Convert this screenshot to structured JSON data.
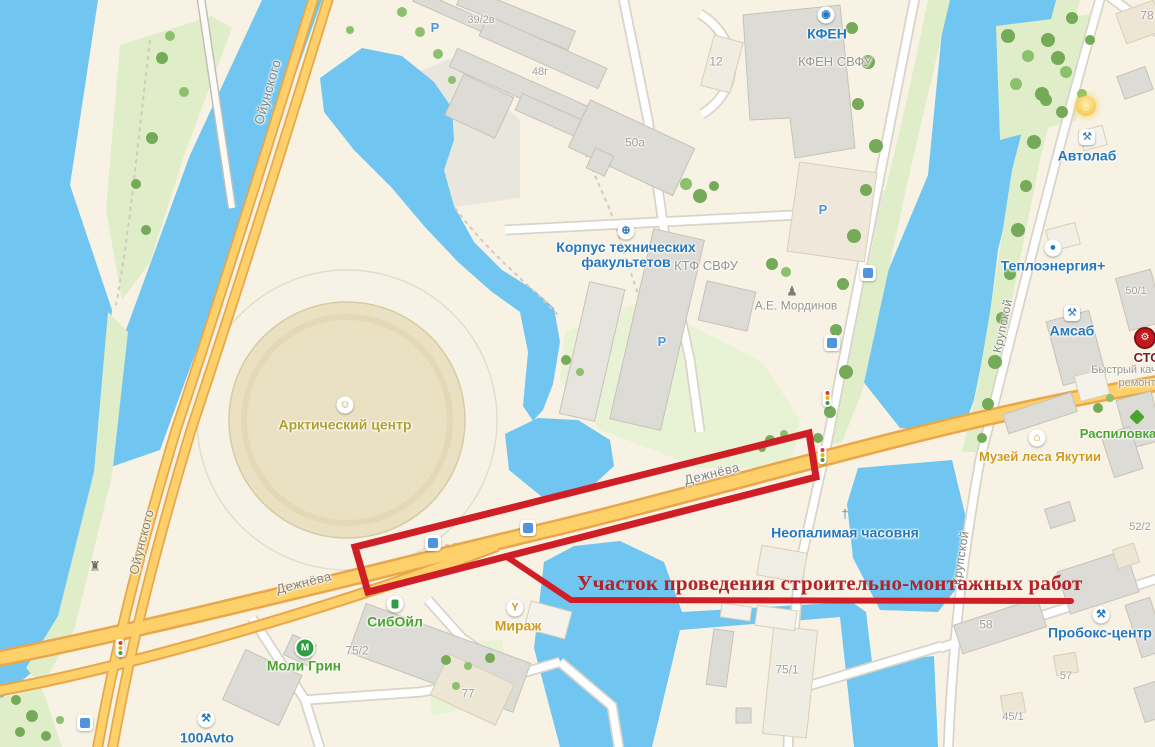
{
  "annotation": {
    "label": "Участок проведения строительно-монтажных работ"
  },
  "colors": {
    "land": "#f7f2e4",
    "water": "#70c6f0",
    "green": "#dfeec8",
    "green2": "#e8f3d6",
    "tree": "#74aa58",
    "tree2": "#8cc06d",
    "roadFill": "#fdd06a",
    "roadCase": "#e8a74b",
    "roadWhite": "#ffffff",
    "roadWhiteCase": "#d9d4c8",
    "building": "#dcdbd5",
    "buildingLine": "#c6c2b8",
    "beige": "#ede6d4",
    "beigeLine": "#d9cfb6",
    "redLine": "#cf1e26",
    "redText": "#b22228",
    "poiBlue": "#2578be",
    "poiGreen": "#4ba42f",
    "poiOrange": "#cf9a1f",
    "poiOlive": "#b0a032",
    "labelGrey": "#97958c",
    "numGrey": "#a29f95",
    "streetGrey": "#84827a",
    "parkingBlue": "#4f94dd"
  },
  "map": {
    "labels": [
      {
        "n": "street-oyunskogo-1",
        "t": "Ойунского",
        "c": "street",
        "x": 268,
        "y": 92,
        "r": -74,
        "ia": false
      },
      {
        "n": "street-oyunskogo-2",
        "t": "Ойунского",
        "c": "street",
        "x": 142,
        "y": 542,
        "r": -76,
        "ia": false
      },
      {
        "n": "street-dezhnyova-1",
        "t": "Дежнёва",
        "c": "street",
        "x": 712,
        "y": 474,
        "r": -14,
        "ia": false
      },
      {
        "n": "street-dezhnyova-2",
        "t": "Дежнёва",
        "c": "street",
        "x": 304,
        "y": 583,
        "r": -14,
        "ia": false
      },
      {
        "n": "street-krupskoy-1",
        "t": "Крупской",
        "c": "street",
        "x": 1003,
        "y": 326,
        "r": -78,
        "fs": 12,
        "ia": false
      },
      {
        "n": "street-krupskoy-2",
        "t": "Крупской",
        "c": "street",
        "x": 961,
        "y": 558,
        "r": -81,
        "fs": 12,
        "ia": false
      },
      {
        "n": "poi-kfen",
        "t": "КФЕН",
        "c": "blue",
        "x": 827,
        "y": 34,
        "ia": true
      },
      {
        "n": "poi-korpus",
        "t": "Корпус технических\nфакультетов",
        "c": "blue",
        "x": 626,
        "y": 255,
        "ia": true
      },
      {
        "n": "poi-avtolab",
        "t": "Автолаб",
        "c": "blue",
        "x": 1087,
        "y": 156,
        "ia": true
      },
      {
        "n": "poi-teploenergia",
        "t": "Теплоэнергия+",
        "c": "blue",
        "x": 1053,
        "y": 266,
        "ia": true
      },
      {
        "n": "poi-amsab",
        "t": "Амсаб",
        "c": "blue",
        "x": 1072,
        "y": 331,
        "ia": true
      },
      {
        "n": "poi-chasovnya",
        "t": "Неопалимая часовня",
        "c": "blue",
        "x": 845,
        "y": 533,
        "ia": true
      },
      {
        "n": "poi-proboks",
        "t": "Пробокс-центр",
        "c": "blue",
        "x": 1100,
        "y": 633,
        "ia": true
      },
      {
        "n": "poi-100avto",
        "t": "100Avto",
        "c": "blue",
        "x": 207,
        "y": 738,
        "ia": true
      },
      {
        "n": "poi-siboil",
        "t": "СибОйл",
        "c": "green",
        "x": 395,
        "y": 622,
        "ia": true
      },
      {
        "n": "poi-moli-grin",
        "t": "Моли Грин",
        "c": "green",
        "x": 304,
        "y": 666,
        "ia": true
      },
      {
        "n": "poi-raspilovka",
        "t": "Распиловка",
        "c": "green",
        "x": 1118,
        "y": 434,
        "fs": 13,
        "ia": true
      },
      {
        "n": "poi-mirazh",
        "t": "Мираж",
        "c": "orange",
        "x": 518,
        "y": 626,
        "ia": true
      },
      {
        "n": "poi-muzey-lesa",
        "t": "Музей леса Якутии",
        "c": "orange",
        "x": 1040,
        "y": 457,
        "fs": 13,
        "ia": true
      },
      {
        "n": "poi-arktichesky-centr",
        "t": "Арктический центр",
        "c": "olive",
        "x": 345,
        "y": 425,
        "ia": true
      },
      {
        "n": "org-kfen-svfu",
        "t": "КФЕН СВФУ",
        "c": "org",
        "x": 835,
        "y": 62,
        "ia": false
      },
      {
        "n": "org-ktf-svfu",
        "t": "КТФ СВФУ",
        "c": "org",
        "x": 706,
        "y": 266,
        "ia": false
      },
      {
        "n": "org-mordinov",
        "t": "А.Е. Мординов",
        "c": "org",
        "x": 796,
        "y": 306,
        "fs": 12,
        "ia": false
      },
      {
        "n": "poi-sto",
        "t": "СТО",
        "c": "sto",
        "x": 1147,
        "y": 358,
        "ia": true
      },
      {
        "n": "org-bystry",
        "t": "Быстрый кач",
        "c": "org",
        "x": 1124,
        "y": 371,
        "fs": 11,
        "ia": false
      },
      {
        "n": "org-remont",
        "t": "ремонт",
        "c": "org",
        "x": 1137,
        "y": 384,
        "fs": 11,
        "ia": false
      },
      {
        "n": "num-39-2v",
        "t": "39/2в",
        "c": "num",
        "x": 481,
        "y": 21,
        "ia": false
      },
      {
        "n": "num-48g",
        "t": "48г",
        "c": "num",
        "x": 540,
        "y": 73,
        "ia": false
      },
      {
        "n": "num-50a",
        "t": "50а",
        "c": "num",
        "x": 635,
        "y": 143,
        "fs": 12,
        "ia": false
      },
      {
        "n": "num-12",
        "t": "12",
        "c": "num",
        "x": 716,
        "y": 62,
        "fs": 12,
        "ia": false
      },
      {
        "n": "num-78",
        "t": "78",
        "c": "num",
        "x": 1147,
        "y": 16,
        "fs": 12,
        "ia": false
      },
      {
        "n": "num-50-1",
        "t": "50/1",
        "c": "num",
        "x": 1136,
        "y": 292,
        "ia": false
      },
      {
        "n": "num-52-2",
        "t": "52/2",
        "c": "num",
        "x": 1140,
        "y": 528,
        "ia": false
      },
      {
        "n": "num-58",
        "t": "58",
        "c": "num",
        "x": 986,
        "y": 625,
        "fs": 12,
        "ia": false
      },
      {
        "n": "num-57",
        "t": "57",
        "c": "num",
        "x": 1066,
        "y": 677,
        "ia": false
      },
      {
        "n": "num-45-1",
        "t": "45/1",
        "c": "num",
        "x": 1013,
        "y": 718,
        "ia": false
      },
      {
        "n": "num-75-1",
        "t": "75/1",
        "c": "num",
        "x": 787,
        "y": 670,
        "fs": 12,
        "ia": false
      },
      {
        "n": "num-75-2",
        "t": "75/2",
        "c": "num",
        "x": 357,
        "y": 651,
        "fs": 12,
        "ia": false
      },
      {
        "n": "num-77",
        "t": "77",
        "c": "num",
        "x": 468,
        "y": 694,
        "fs": 12,
        "ia": false
      },
      {
        "n": "parking-1",
        "t": "Р",
        "c": "parking",
        "x": 435,
        "y": 28,
        "ia": true
      },
      {
        "n": "parking-2",
        "t": "Р",
        "c": "parking",
        "x": 823,
        "y": 210,
        "ia": true
      },
      {
        "n": "parking-3",
        "t": "Р",
        "c": "parking",
        "x": 662,
        "y": 342,
        "ia": true
      }
    ],
    "icons": [
      {
        "n": "kfen-icon",
        "t": "circle",
        "x": 826,
        "y": 15,
        "g": "◉",
        "c": "#2578be",
        "ia": true
      },
      {
        "n": "globe-icon",
        "t": "circle",
        "x": 626,
        "y": 231,
        "g": "⊕",
        "c": "#2578be",
        "ia": true
      },
      {
        "n": "lamp-icon",
        "t": "yellow",
        "x": 1086,
        "y": 106,
        "g": "☼",
        "ia": true
      },
      {
        "n": "avtolab-tools-icon",
        "t": "square",
        "x": 1087,
        "y": 137,
        "g": "⚒",
        "c": "#2578be",
        "ia": true
      },
      {
        "n": "teploenergia-icon",
        "t": "circle",
        "x": 1053,
        "y": 248,
        "g": "●",
        "c": "#2578be",
        "ia": true
      },
      {
        "n": "amsab-tools-icon",
        "t": "square",
        "x": 1072,
        "y": 313,
        "g": "⚒",
        "c": "#2578be",
        "ia": true
      },
      {
        "n": "sto-gear-icon",
        "t": "red",
        "x": 1145,
        "y": 338,
        "g": "⚙",
        "ia": true
      },
      {
        "n": "museum-icon",
        "t": "circle",
        "x": 1037,
        "y": 438,
        "g": "⌂",
        "c": "#c8961e",
        "ia": true
      },
      {
        "n": "raspilovka-diamond-icon",
        "t": "diamond",
        "x": 1137,
        "y": 417,
        "ia": true
      },
      {
        "n": "chapel-cross-icon",
        "t": "plain",
        "x": 845,
        "y": 514,
        "g": "†",
        "c": "#5d8fc0",
        "ia": true
      },
      {
        "n": "fuel-pump-icon",
        "t": "pump",
        "x": 395,
        "y": 604,
        "ia": true
      },
      {
        "n": "cocktail-icon",
        "t": "circle",
        "x": 515,
        "y": 608,
        "g": "Y",
        "c": "#cf9a1f",
        "ia": true
      },
      {
        "n": "moli-grin-icon",
        "t": "drop",
        "x": 305,
        "y": 648,
        "g": "М",
        "ia": true
      },
      {
        "n": "proboks-tools-icon",
        "t": "circle",
        "x": 1101,
        "y": 615,
        "g": "⚒",
        "c": "#2578be",
        "ia": true
      },
      {
        "n": "100avto-tools-icon",
        "t": "circle",
        "x": 206,
        "y": 719,
        "g": "⚒",
        "c": "#2578be",
        "ia": true
      },
      {
        "n": "theater-masks-icon",
        "t": "circle",
        "x": 345,
        "y": 405,
        "g": "☺",
        "c": "#b0a032",
        "ia": true
      },
      {
        "n": "statue-icon",
        "t": "plain",
        "x": 792,
        "y": 291,
        "g": "♟",
        "c": "#7d7b72",
        "ia": false
      },
      {
        "n": "monument-icon",
        "t": "plain",
        "x": 95,
        "y": 566,
        "g": "♜",
        "c": "#6e6c64",
        "ia": false
      },
      {
        "n": "bus-stop-icon",
        "t": "bus",
        "x": 433,
        "y": 543,
        "ia": true
      },
      {
        "n": "bus-stop-icon",
        "t": "bus",
        "x": 528,
        "y": 528,
        "ia": true
      },
      {
        "n": "bus-stop-icon",
        "t": "bus",
        "x": 868,
        "y": 273,
        "ia": true
      },
      {
        "n": "bus-stop-icon",
        "t": "bus",
        "x": 832,
        "y": 343,
        "ia": true
      },
      {
        "n": "bus-stop-icon",
        "t": "bus",
        "x": 85,
        "y": 723,
        "ia": true
      },
      {
        "n": "traffic-light-icon",
        "t": "light",
        "x": 827,
        "y": 398,
        "ia": false
      },
      {
        "n": "traffic-light-icon",
        "t": "light",
        "x": 822,
        "y": 455,
        "ia": false
      },
      {
        "n": "traffic-light-icon",
        "t": "light",
        "x": 120,
        "y": 648,
        "ia": false
      }
    ]
  }
}
